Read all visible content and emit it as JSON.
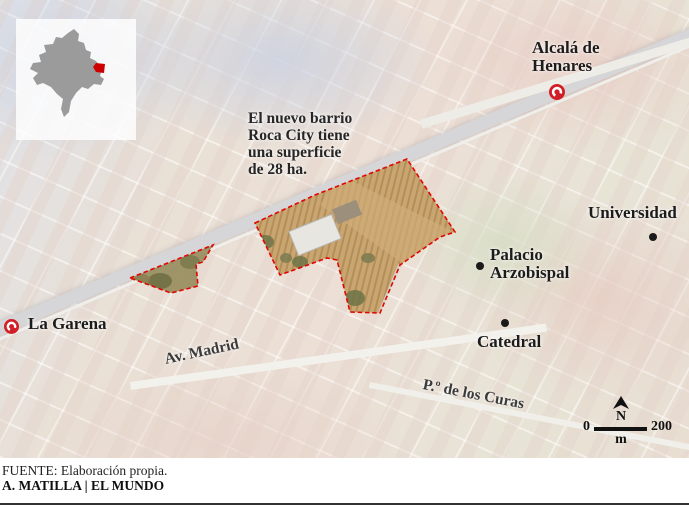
{
  "page": {
    "background": "#ffffff",
    "top_accent_color": "#d40000",
    "bottom_rule_color": "#333333"
  },
  "inset": {
    "region_color": "#9b9b9b",
    "highlight_color": "#cc0000",
    "panel_color": "rgba(255,255,255,0.82)"
  },
  "map": {
    "annotation": {
      "line1": "El nuevo barrio",
      "line2": "Roca City tiene",
      "line3": "una superficie",
      "line4": "de 28 ha."
    },
    "labels": {
      "alcala": {
        "line1": "Alcalá de",
        "line2": "Henares"
      },
      "universidad": "Universidad",
      "palacio": {
        "line1": "Palacio",
        "line2": "Arzobispal"
      },
      "catedral": "Catedral",
      "la_garena": "La Garena",
      "av_madrid": "Av. Madrid",
      "paseo_curas": "P.º de los Curas"
    },
    "compass_north": "N",
    "scale": {
      "start": "0",
      "end": "200",
      "unit": "m"
    },
    "colors": {
      "highlight_outline": "#e10600",
      "highlight_fill": "#c7a36d",
      "station_icon": "#d21f26",
      "poi_dot": "#1a1a1a"
    }
  },
  "footer": {
    "source": "FUENTE: Elaboración propia.",
    "credit": "A. MATILLA | EL MUNDO"
  }
}
